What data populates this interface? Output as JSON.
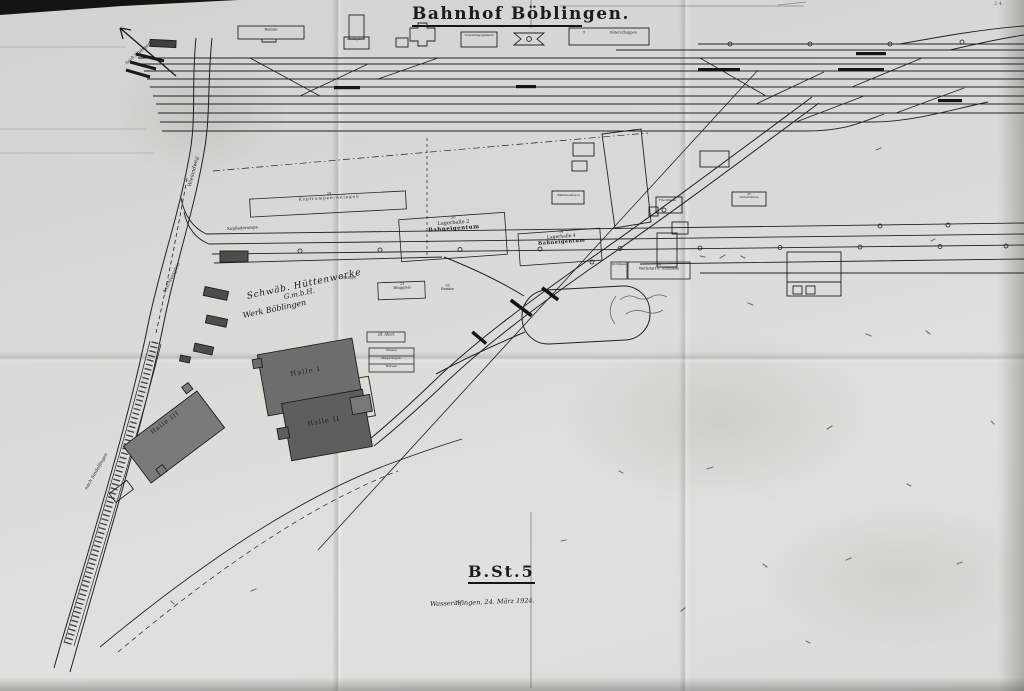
{
  "meta": {
    "title": "Bahnhof Böblingen.",
    "plan_number": "B.St.5",
    "date_note": "Wasseralfingen, 24. März 1924.",
    "corner_mark": "2 4"
  },
  "company": {
    "line1": "Schwäb. Hüttenwerke",
    "line2": "G.m.b.H.",
    "line3": "Werk Böblingen"
  },
  "halls": {
    "h1": "Halle I",
    "h2": "Halle II",
    "h3": "Halle III"
  },
  "labels": {
    "lagerhalle2": {
      "num": "30",
      "name": "Lagerhalle 2",
      "owner": "Bahneigentum"
    },
    "lagerhalle4": {
      "num": "34",
      "name": "Lagerhalle 4",
      "owner": "Bahneigentum"
    },
    "werkstatt": {
      "num": "30",
      "name": "Werkstatt u. Schmiede",
      "annex": "Wohnhaus"
    },
    "kopframpe": {
      "num": "29",
      "name": "Kopframpen-Anlagen"
    },
    "kopfladerampe": "Kopfladerampe",
    "rampe": "Rampe",
    "ringgleis": {
      "num": "23",
      "name": "Ringgleis"
    },
    "remise": {
      "num": "26",
      "name": "Remise"
    },
    "alt_abort": "alt. Abort",
    "oelhaus": "Ölhaus",
    "magazin": "Magazingeb.",
    "bureau": "Bureau",
    "frachthalle": "Frachthalle",
    "gueterremise": {
      "num": "38",
      "name": "Güterremise"
    },
    "bahnmeisterei": "Bahnmeisterei",
    "remise_top": "Remise",
    "dienstgeb": "Dienstgeb. 4",
    "verwaltung": "Verwaltungsgebäude",
    "gueterschuppen": {
      "num": "5",
      "name": "Güterschuppen"
    }
  },
  "annotations": {
    "street": "Wielandweg",
    "anschlussgleis": "Anschlussgleis",
    "nach_sindelfingen": "nach Sindelfingen",
    "nach_stuttgart": "nach Stuttgart"
  },
  "colors": {
    "paper": "#d9d9d5",
    "ink": "#1c1c1c",
    "hall_fill": "#6b6b6b"
  }
}
